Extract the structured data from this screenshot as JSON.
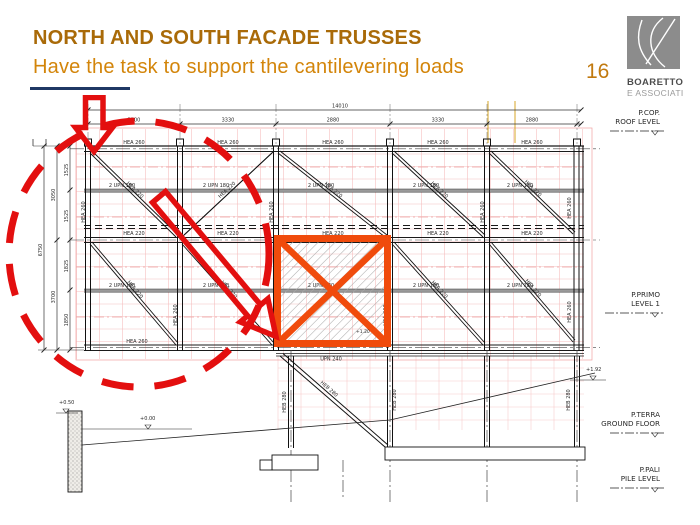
{
  "header": {
    "title": "NORTH AND SOUTH FACADE TRUSSES",
    "subtitle": "Have the task to support the cantilevering loads",
    "page_number": "16",
    "logo": {
      "name": "BOARETTO",
      "tagline": "E ASSOCIATI"
    }
  },
  "colors": {
    "title": "#A96A08",
    "subtitle": "#D3850A",
    "underline": "#1F3864",
    "annotation_red": "#E30F0F",
    "highlight_orange": "#F04B0C",
    "grid_pink": "#F0A4A4",
    "logo_gray": "#8C8C8C"
  },
  "drawing": {
    "dimensions": {
      "total_span": "14010",
      "bay_spans": [
        "3300",
        "3330",
        "2880",
        "3330",
        "2880"
      ],
      "total_height": "6750",
      "height_groups": [
        "3050",
        "3700"
      ],
      "height_segments": [
        "1525",
        "1525",
        "1825",
        "1850"
      ]
    },
    "members": {
      "top_chord": "HEA 260",
      "middle_chord": "HEA 220",
      "bottom_chord": "HEA 260",
      "purlin": "2 UPN 180",
      "diagonal": "HEA 220",
      "vertical": "HEA 260",
      "tie_beam": "UPN 240",
      "column": "HEB 280"
    },
    "levels": [
      {
        "abbr": "P.COP.",
        "name": "ROOF LEVEL"
      },
      {
        "abbr": "P.PRIMO",
        "name": "LEVEL 1"
      },
      {
        "abbr": "P.TERRA",
        "name": "GROUND FLOOR"
      },
      {
        "abbr": "P.PALI",
        "name": "PILE LEVEL"
      }
    ],
    "spot_levels": {
      "wall_top": "+0.50",
      "ground": "+0.00",
      "terrain_right": "+1.92",
      "square_note": "+1.20"
    }
  }
}
